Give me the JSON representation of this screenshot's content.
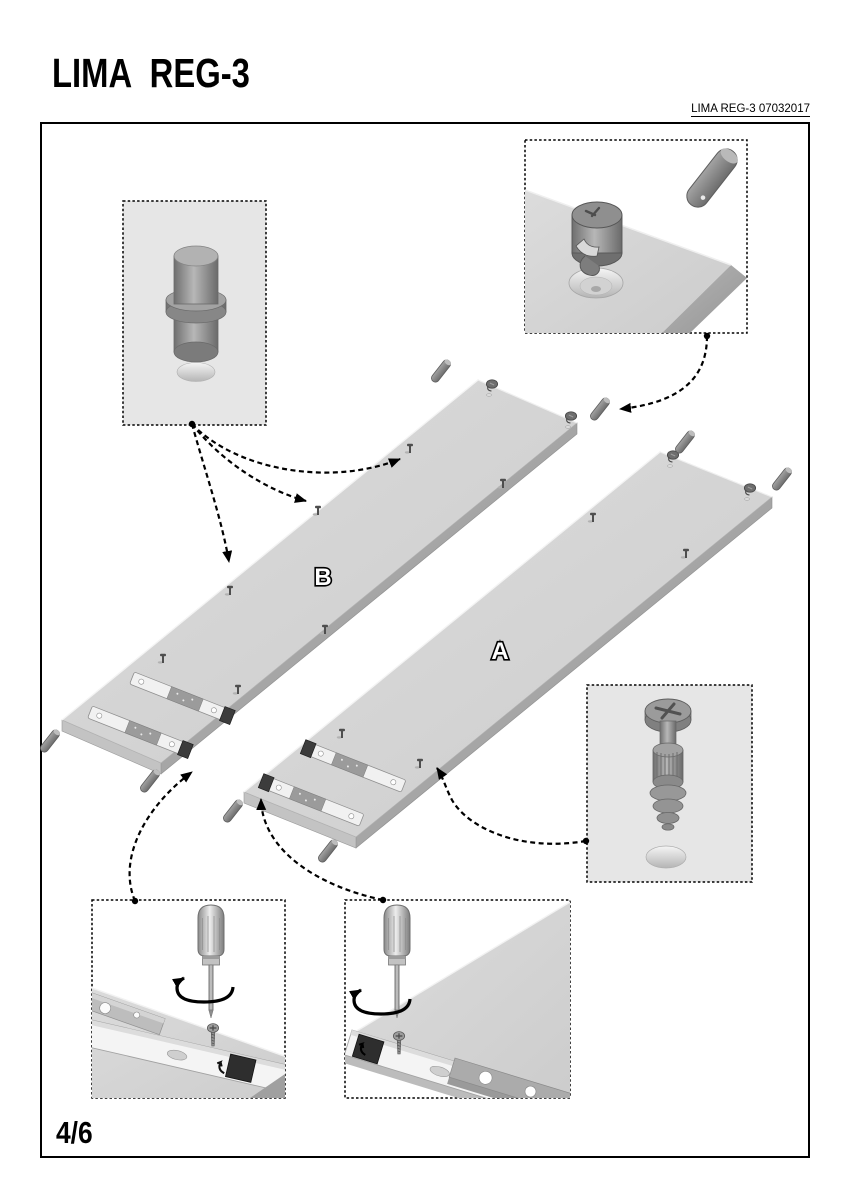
{
  "page": {
    "title": "LIMA REG-3",
    "doc_ref": "LIMA REG-3 07032017",
    "page_indicator": "4/6"
  },
  "panels": {
    "a": {
      "label": "A"
    },
    "b": {
      "label": "B"
    }
  },
  "colors": {
    "background": "#ffffff",
    "frame_border": "#000000",
    "panel_face": "#d6d6d6",
    "panel_edge": "#a6a6a6",
    "hardware_gray": "#7d7d7d",
    "callout_background": "#e6e6e6",
    "leader_arrow": "#000000",
    "rail_dark_end": "#2e2e2e"
  }
}
